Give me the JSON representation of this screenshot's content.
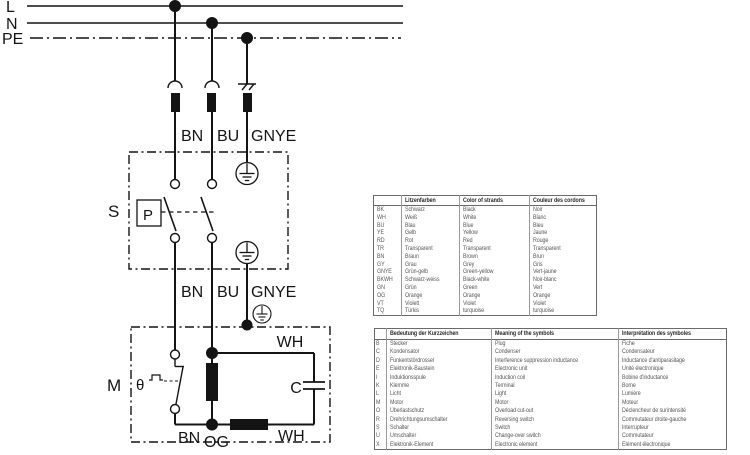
{
  "colors": {
    "line": "#141414",
    "table_border": "#9a9a9a",
    "table_text": "#585858",
    "header_text": "#2a2a2a",
    "background": "#ffffff"
  },
  "diagram": {
    "bus_labels": {
      "l": "L",
      "n": "N",
      "pe": "PE"
    },
    "top_wire_labels": {
      "bn": "BN",
      "bu": "BU",
      "gnye": "GNYE"
    },
    "mid_wire_labels": {
      "bn": "BN",
      "bu": "BU",
      "gnye": "GNYE"
    },
    "switch_section_label": "S",
    "pressure_switch_label": "P",
    "motor_section_label": "M",
    "thermal_contact_label": "θ",
    "capacitor_label": "C",
    "motor_wire_labels": {
      "aux_top": "WH",
      "bn": "BN",
      "og": "OG",
      "aux_bottom": "WH"
    }
  },
  "color_table": {
    "headers": [
      "",
      "Litzenfarben",
      "Color of strands",
      "Couleur des cordons"
    ],
    "rows": [
      [
        "BK",
        "Schwarz",
        "Black",
        "Noir"
      ],
      [
        "WH",
        "Weiß",
        "White",
        "Blanc"
      ],
      [
        "BU",
        "Blau",
        "Blue",
        "Bleu"
      ],
      [
        "YE",
        "Gelb",
        "Yellow",
        "Jaune"
      ],
      [
        "RD",
        "Rot",
        "Red",
        "Rouge"
      ],
      [
        "TR",
        "Transparent",
        "Transparent",
        "Transparent"
      ],
      [
        "BN",
        "Braun",
        "Brown",
        "Brun"
      ],
      [
        "GY",
        "Grau",
        "Grey",
        "Gris"
      ],
      [
        "GNYE",
        "Grün-gelb",
        "Green-yellow",
        "Vert-jaune"
      ],
      [
        "BKWH",
        "Schwarz-weiss",
        "Black-white",
        "Noir-blanc"
      ],
      [
        "GN",
        "Grün",
        "Green",
        "Vert"
      ],
      [
        "OG",
        "Orange",
        "Orange",
        "Orange"
      ],
      [
        "VT",
        "Violett",
        "Violet",
        "Violet"
      ],
      [
        "TQ",
        "Türkis",
        "turquoise",
        "turquoise"
      ]
    ]
  },
  "symbol_table": {
    "headers": [
      "",
      "Bedeutung der Kurzzeichen",
      "Meaning of the symbols",
      "Interprétation des symboles"
    ],
    "rows": [
      [
        "B",
        "Stecker",
        "Plug",
        "Fiche"
      ],
      [
        "C",
        "Kondensator",
        "Condenser",
        "Condensateur"
      ],
      [
        "D",
        "Funkentstördrossel",
        "Interference suppression inductance",
        "Inductance d'antiparasitage"
      ],
      [
        "E",
        "Elektronik-Baustein",
        "Electronic unit",
        "Unité électronique"
      ],
      [
        "I",
        "Induktionsspule",
        "Induction coil",
        "Bobine d'inductance"
      ],
      [
        "K",
        "Klemme",
        "Terminal",
        "Borne"
      ],
      [
        "L",
        "Licht",
        "Light",
        "Lumière"
      ],
      [
        "M",
        "Motor",
        "Motor",
        "Moteur"
      ],
      [
        "O",
        "Überlastschutz",
        "Overload cut-out",
        "Déclencheur de surintensité"
      ],
      [
        "R",
        "Drehrichtungsumschalter",
        "Reversing switch",
        "Commutateur droite-gauche"
      ],
      [
        "S",
        "Schalter",
        "Switch",
        "Interrupteur"
      ],
      [
        "U",
        "Umschalter",
        "Change-over switch",
        "Commutateur"
      ],
      [
        "X",
        "Elektronik-Element",
        "Electronic element",
        "Elément électronique"
      ]
    ]
  }
}
